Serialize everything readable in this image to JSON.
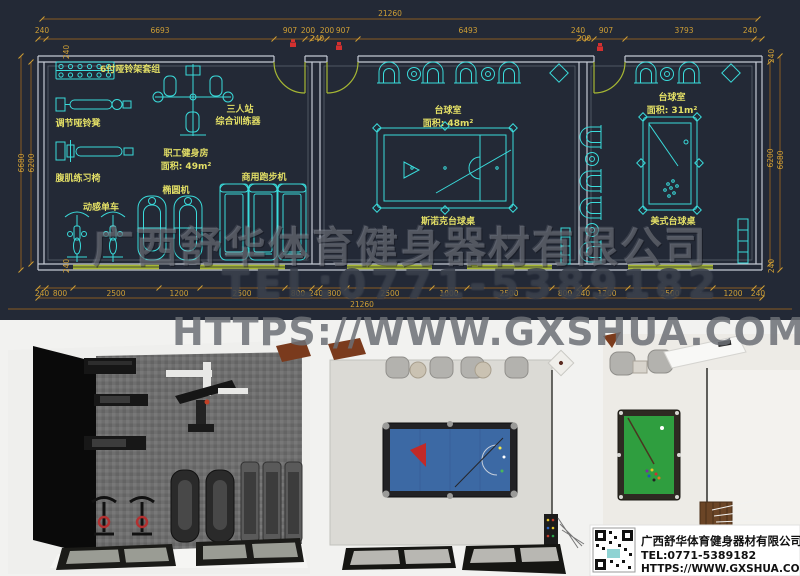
{
  "watermark": {
    "company": "广西舒华体育健身器材有限公司",
    "tel": "TEL:0771-5389182",
    "url": "HTTPS://WWW.GXSHUA.COM"
  },
  "info_box": {
    "company": "广西舒华体育健身器材有限公司",
    "tel": "TEL:0771-5389182",
    "url": "HTTPS://WWW.GXSHUA.COM"
  },
  "plan": {
    "total_top": "21260",
    "total_bottom": "21260",
    "top_dims": [
      "240",
      "6693",
      "907",
      "200",
      "240",
      "200",
      "907",
      "6493",
      "240",
      "200",
      "907",
      "3793",
      "240"
    ],
    "bottom_dims": [
      "240",
      "800",
      "2500",
      "1200",
      "2500",
      "800",
      "240",
      "800",
      "2500",
      "1000",
      "2500",
      "800",
      "240",
      "1200",
      "2500",
      "1200",
      "240"
    ],
    "left_dims": {
      "total": "6680",
      "inner": "6200",
      "top": "240",
      "bottom": "240"
    },
    "right_dims": {
      "total": "6680",
      "inner": "6200",
      "top": "240",
      "bottom": "240"
    },
    "gym": {
      "name": "职工健身房",
      "area": "面积: 49m²",
      "labels": {
        "rack": "6付哑铃架套组",
        "bench": "调节哑铃凳",
        "trainer1": "三人站",
        "trainer2": "综合训练器",
        "ab": "腹肌练习椅",
        "spin": "动感单车",
        "elliptical": "椭圆机",
        "treadmill": "商用跑步机"
      }
    },
    "billiard1": {
      "name": "台球室",
      "area": "面积: 48m²",
      "table": "斯诺克台球桌"
    },
    "billiard2": {
      "name": "台球室",
      "area": "面积: 31m²",
      "table": "美式台球桌"
    }
  },
  "colors": {
    "cad_background": "#232936",
    "equipment_cyan": "#3adbdb",
    "label_yellow": "#e3df66",
    "dimension_gold": "#cf9f35",
    "door_green": "#a6b733",
    "wall_gray": "#c3c9d3",
    "tag_red": "#d23030",
    "snooker_felt_blue": "#3c69a4",
    "pool_felt_green": "#2f9e3f"
  }
}
